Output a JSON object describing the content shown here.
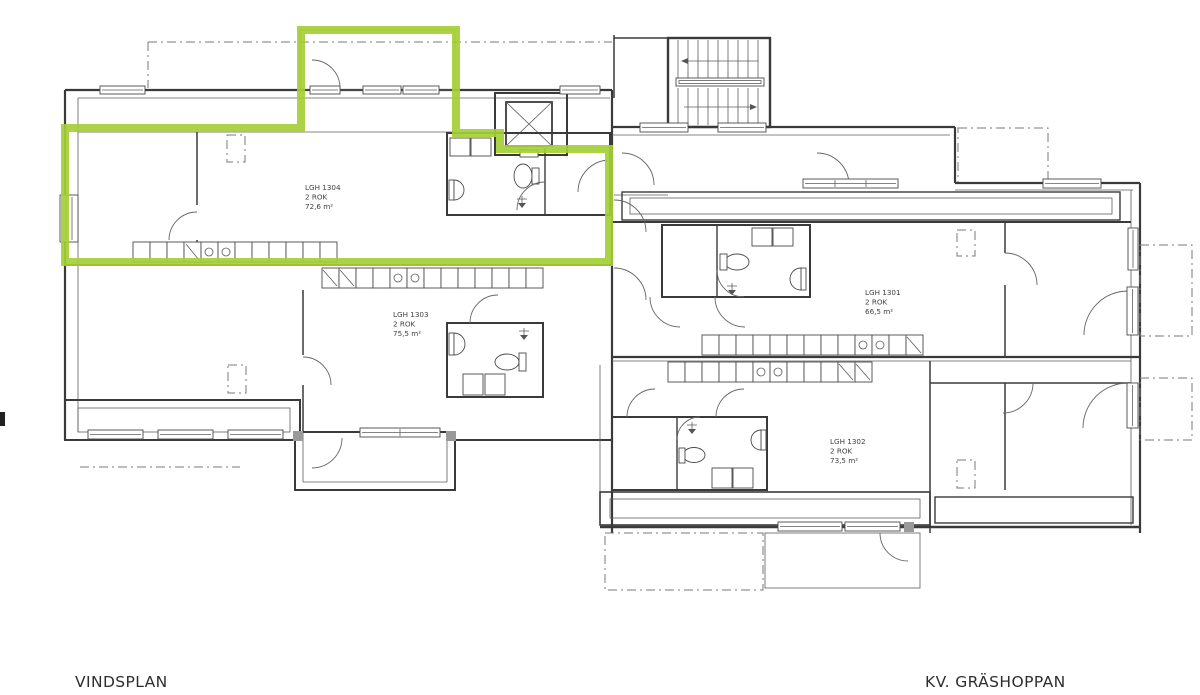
{
  "page": {
    "background": "#ffffff"
  },
  "plan": {
    "floor_label": "VINDSPLAN",
    "block_label": "KV. GRÄSHOPPAN"
  },
  "highlight": {
    "color": "#a5ce35",
    "highlighted_apartment": "LGH 1304"
  },
  "apartments": [
    {
      "id": "LGH 1304",
      "rooms": "2 ROK",
      "area": "72,6 m²"
    },
    {
      "id": "LGH 1303",
      "rooms": "2 ROK",
      "area": "75,5 m²"
    },
    {
      "id": "LGH 1301",
      "rooms": "2 ROK",
      "area": "66,5 m²"
    },
    {
      "id": "LGH 1302",
      "rooms": "2 ROK",
      "area": "73,5 m²"
    }
  ]
}
